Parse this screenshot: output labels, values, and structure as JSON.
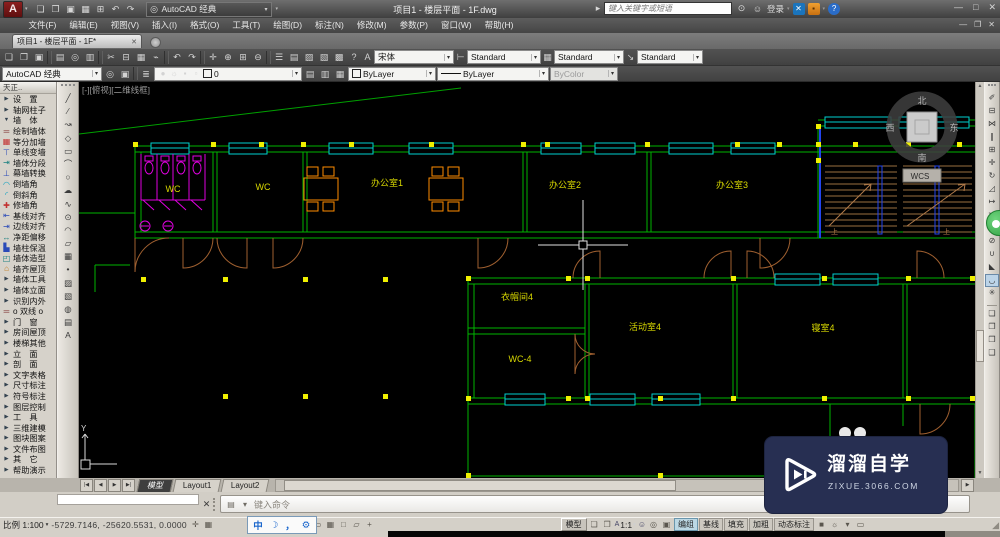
{
  "colors": {
    "canvas_bg": "#000000",
    "wall_green": "#00b400",
    "window_cyan": "#00d0d0",
    "grip_yellow": "#f0f000",
    "fixture_magenta": "#e000e0",
    "furniture_orange": "#ff8c00",
    "door_brown": "#a06030",
    "label_yellow": "#d8d800",
    "stair_rail_blue": "#2244ee",
    "watermark_bg": "#272f52",
    "badge_green": "#2fae3f"
  },
  "titlebar": {
    "logo": "A",
    "qat": [
      {
        "n": "new-button",
        "icn": "new-file",
        "i": "❏"
      },
      {
        "n": "open-button",
        "icn": "open-folder",
        "i": "❐"
      },
      {
        "n": "save-button",
        "icn": "save",
        "i": "▣"
      },
      {
        "n": "saveas-button",
        "icn": "save-as",
        "i": "▦"
      },
      {
        "n": "plot-button",
        "icn": "printer",
        "i": "⊞"
      },
      {
        "n": "undo-button",
        "icn": "undo-arrow",
        "i": "↶"
      },
      {
        "n": "redo-button",
        "icn": "redo-arrow",
        "i": "↷"
      }
    ],
    "workspace": "AutoCAD 经典",
    "title": "项目1 - 楼层平面 - 1F.dwg",
    "search_placeholder": "键入关键字或短语",
    "search_arrow": "▸",
    "binocular": "⊙",
    "person": "☺",
    "signin": "登录",
    "exchange_x": "✕",
    "win": {
      "min": "—",
      "max": "□",
      "close": "✕"
    },
    "help_q": "?"
  },
  "menubar": {
    "items": [
      {
        "label": "文件(F)",
        "n": "menu-file"
      },
      {
        "label": "编辑(E)",
        "n": "menu-edit"
      },
      {
        "label": "视图(V)",
        "n": "menu-view"
      },
      {
        "label": "插入(I)",
        "n": "menu-insert"
      },
      {
        "label": "格式(O)",
        "n": "menu-format"
      },
      {
        "label": "工具(T)",
        "n": "menu-tools"
      },
      {
        "label": "绘图(D)",
        "n": "menu-draw"
      },
      {
        "label": "标注(N)",
        "n": "menu-dimension"
      },
      {
        "label": "修改(M)",
        "n": "menu-modify"
      },
      {
        "label": "参数(P)",
        "n": "menu-parametric"
      },
      {
        "label": "窗口(W)",
        "n": "menu-window"
      },
      {
        "label": "帮助(H)",
        "n": "menu-help"
      }
    ],
    "win": {
      "min": "—",
      "restore": "❐",
      "close": "✕"
    }
  },
  "tabbar": {
    "tab": "项目1 - 楼层平面 - 1F*",
    "close": "✕"
  },
  "toolbar1": {
    "icons": [
      {
        "n": "new-button",
        "icn": "new-file",
        "i": "❏"
      },
      {
        "n": "open-button",
        "icn": "open-folder",
        "i": "❐"
      },
      {
        "n": "save-button",
        "icn": "save",
        "i": "▣"
      },
      {
        "sep": true
      },
      {
        "n": "plot-button",
        "icn": "printer",
        "i": "▤"
      },
      {
        "n": "preview-button",
        "icn": "print-preview",
        "i": "◎"
      },
      {
        "n": "publish-button",
        "icn": "publish",
        "i": "▥"
      },
      {
        "sep": true
      },
      {
        "n": "cut-button",
        "icn": "scissors",
        "i": "✂"
      },
      {
        "n": "copy-button",
        "icn": "copy",
        "i": "⊟"
      },
      {
        "n": "paste-button",
        "icn": "clipboard",
        "i": "▦"
      },
      {
        "n": "match-properties-button",
        "icn": "paintbrush",
        "i": "⌁"
      },
      {
        "sep": true
      },
      {
        "n": "undo-button",
        "icn": "undo-arrow",
        "i": "↶"
      },
      {
        "n": "redo-button",
        "icn": "redo-arrow",
        "i": "↷"
      },
      {
        "sep": true
      },
      {
        "n": "pan-button",
        "icn": "pan-hand",
        "i": "✛"
      },
      {
        "n": "zoom-realtime-button",
        "icn": "zoom-plus",
        "i": "⊕"
      },
      {
        "n": "zoom-window-button",
        "icn": "zoom-window",
        "i": "⊞"
      },
      {
        "n": "zoom-previous-button",
        "icn": "zoom-minus",
        "i": "⊖"
      },
      {
        "sep": true
      },
      {
        "n": "properties-button",
        "icn": "properties",
        "i": "☰"
      },
      {
        "n": "design-center-button",
        "icn": "design-center",
        "i": "▤"
      },
      {
        "n": "tool-palettes-button",
        "icn": "tool-palettes",
        "i": "▨"
      },
      {
        "n": "sheet-set-button",
        "icn": "sheet-set",
        "i": "▧"
      },
      {
        "n": "markup-button",
        "icn": "markup",
        "i": "▩"
      },
      {
        "n": "help-button",
        "icn": "question-mark",
        "i": "?"
      }
    ],
    "style_icons": [
      {
        "i": "A"
      },
      {
        "i": "⊢"
      },
      {
        "i": "▦"
      },
      {
        "i": "↘"
      }
    ],
    "text_style": "宋体",
    "dim_style": "Standard",
    "table_style": "Standard",
    "mleader_style": "Standard"
  },
  "toolbar2": {
    "workspace": "AutoCAD 经典",
    "ws_icons": [
      {
        "n": "workspace-settings-button",
        "icn": "gear",
        "i": "◎"
      },
      {
        "n": "workspace-save-button",
        "icn": "save",
        "i": "▣"
      }
    ],
    "layer_props_icon": {
      "i": "≣"
    },
    "layer_icons": [
      {
        "n": "layer-on-toggle",
        "icn": "lightbulb",
        "i": "●",
        "c": "yel"
      },
      {
        "n": "layer-freeze-toggle",
        "icn": "sun",
        "i": "☼",
        "c": "org"
      },
      {
        "n": "layer-lock-toggle",
        "icn": "lock",
        "i": "▪",
        "c": "gry"
      },
      {
        "n": "layer-plot-toggle",
        "icn": "plot",
        "i": "▫",
        "c": "gry"
      }
    ],
    "layer": "0",
    "layer_btns": [
      {
        "n": "layer-states-button",
        "icn": "layer-states",
        "i": "▤"
      },
      {
        "n": "layer-previous-button",
        "icn": "layer-previous",
        "i": "▥"
      },
      {
        "n": "layer-isolate-button",
        "icn": "layer-isolate",
        "i": "▦"
      }
    ],
    "color": "ByLayer",
    "linetype": "ByLayer",
    "plot_style": "ByColor"
  },
  "palette": {
    "title": "天正..",
    "items": [
      {
        "i": "▶",
        "c": "arr",
        "label": "设　置",
        "n": "palette-settings"
      },
      {
        "i": "▶",
        "c": "arr",
        "label": "轴网柱子",
        "n": "palette-axis-column"
      },
      {
        "i": "▼",
        "c": "arr",
        "label": "墙　体",
        "n": "palette-wall-group"
      },
      {
        "i": "═",
        "c": "mrn",
        "label": "绘制墙体",
        "n": "palette-draw-wall"
      },
      {
        "i": "▦",
        "c": "red",
        "label": "等分加墙",
        "n": "palette-divide-wall"
      },
      {
        "i": "⊤",
        "c": "blu",
        "label": "单线变墙",
        "n": "palette-line-to-wall"
      },
      {
        "i": "⇥",
        "c": "tea",
        "label": "墙体分段",
        "n": "palette-wall-segment"
      },
      {
        "i": "⊥",
        "c": "blu",
        "label": "幕墙转换",
        "n": "palette-curtain-wall"
      },
      {
        "i": "◠",
        "c": "cya",
        "label": "倒墙角",
        "n": "palette-wall-fillet"
      },
      {
        "i": "◜",
        "c": "cya",
        "label": "倒斜角",
        "n": "palette-wall-chamfer"
      },
      {
        "i": "✚",
        "c": "red",
        "label": "修墙角",
        "n": "palette-fix-wall-corner"
      },
      {
        "i": "⇤",
        "c": "blu",
        "label": "基线对齐",
        "n": "palette-baseline-align"
      },
      {
        "i": "⇥",
        "c": "blu",
        "label": "边线对齐",
        "n": "palette-edge-align"
      },
      {
        "i": "↔",
        "c": "tea",
        "label": "净距偏移",
        "n": "palette-clear-offset"
      },
      {
        "i": "▙",
        "c": "blu",
        "label": "墙柱保温",
        "n": "palette-wall-insulation"
      },
      {
        "i": "◰",
        "c": "tea",
        "label": "墙体造型",
        "n": "palette-wall-modeling"
      },
      {
        "i": "⌂",
        "c": "org",
        "label": "墙齐屋顶",
        "n": "palette-wall-to-roof"
      },
      {
        "i": "▶",
        "c": "arr",
        "label": "墙体工具",
        "n": "palette-wall-tools"
      },
      {
        "i": "▶",
        "c": "arr",
        "label": "墙体立面",
        "n": "palette-wall-elevation"
      },
      {
        "i": "▶",
        "c": "arr",
        "label": "识别内外",
        "n": "palette-recognize-inout"
      },
      {
        "i": "═",
        "c": "mrn",
        "label": "o 双线 o",
        "n": "palette-double-line-toggle"
      },
      {
        "i": "▶",
        "c": "arr",
        "label": "门　窗",
        "n": "palette-door-window"
      },
      {
        "i": "▶",
        "c": "arr",
        "label": "房间屋顶",
        "n": "palette-room-roof"
      },
      {
        "i": "▶",
        "c": "arr",
        "label": "楼梯其他",
        "n": "palette-stairs-other"
      },
      {
        "i": "▶",
        "c": "arr",
        "label": "立　面",
        "n": "palette-elevation"
      },
      {
        "i": "▶",
        "c": "arr",
        "label": "剖　面",
        "n": "palette-section"
      },
      {
        "i": "▶",
        "c": "arr",
        "label": "文字表格",
        "n": "palette-text-table"
      },
      {
        "i": "▶",
        "c": "arr",
        "label": "尺寸标注",
        "n": "palette-dimension"
      },
      {
        "i": "▶",
        "c": "arr",
        "label": "符号标注",
        "n": "palette-symbol-annotation"
      },
      {
        "i": "▶",
        "c": "arr",
        "label": "图层控制",
        "n": "palette-layer-control"
      },
      {
        "i": "▶",
        "c": "arr",
        "label": "工　具",
        "n": "palette-tools"
      },
      {
        "i": "▶",
        "c": "arr",
        "label": "三维建模",
        "n": "palette-3d-modeling"
      },
      {
        "i": "▶",
        "c": "arr",
        "label": "图块图案",
        "n": "palette-block-pattern"
      },
      {
        "i": "▶",
        "c": "arr",
        "label": "文件布图",
        "n": "palette-file-layout"
      },
      {
        "i": "▶",
        "c": "arr",
        "label": "其　它",
        "n": "palette-others"
      },
      {
        "i": "▶",
        "c": "arr",
        "label": "帮助演示",
        "n": "palette-help-demo"
      }
    ]
  },
  "draw_toolbar": {
    "icons": [
      {
        "n": "line-tool",
        "icn": "line",
        "i": "╱"
      },
      {
        "n": "xline-tool",
        "icn": "construction-line",
        "i": "∕"
      },
      {
        "n": "polyline-tool",
        "icn": "polyline",
        "i": "↝"
      },
      {
        "n": "polygon-tool",
        "icn": "polygon",
        "i": "◇"
      },
      {
        "n": "rectangle-tool",
        "icn": "rectangle",
        "i": "▭"
      },
      {
        "n": "arc-tool",
        "icn": "arc",
        "i": "⌒"
      },
      {
        "n": "circle-tool",
        "icn": "circle",
        "i": "○"
      },
      {
        "n": "revcloud-tool",
        "icn": "revision-cloud",
        "i": "☁"
      },
      {
        "n": "spline-tool",
        "icn": "spline",
        "i": "∿"
      },
      {
        "n": "ellipse-tool",
        "icn": "ellipse",
        "i": "⊙"
      },
      {
        "n": "ellipse-arc-tool",
        "icn": "ellipse-arc",
        "i": "◠"
      },
      {
        "n": "insert-block-tool",
        "icn": "insert-block",
        "i": "▱"
      },
      {
        "n": "make-block-tool",
        "icn": "make-block",
        "i": "▦"
      },
      {
        "n": "point-tool",
        "icn": "point",
        "i": "•"
      },
      {
        "n": "hatch-tool",
        "icn": "hatch",
        "i": "▨"
      },
      {
        "n": "gradient-tool",
        "icn": "gradient",
        "i": "▧"
      },
      {
        "n": "region-tool",
        "icn": "region",
        "i": "◍"
      },
      {
        "n": "table-tool",
        "icn": "table",
        "i": "▤"
      },
      {
        "n": "mtext-tool",
        "icn": "multiline-text",
        "i": "A"
      }
    ]
  },
  "modify_toolbar": {
    "icons": [
      {
        "n": "erase-tool",
        "icn": "eraser",
        "i": "✐"
      },
      {
        "n": "copy-tool",
        "icn": "copy",
        "i": "⊟"
      },
      {
        "n": "mirror-tool",
        "icn": "mirror",
        "i": "⋈"
      },
      {
        "n": "offset-tool",
        "icn": "offset",
        "i": "∥"
      },
      {
        "n": "array-tool",
        "icn": "array",
        "i": "⊞"
      },
      {
        "n": "move-tool",
        "icn": "move",
        "i": "✛"
      },
      {
        "n": "rotate-tool",
        "icn": "rotate",
        "i": "↻"
      },
      {
        "n": "scale-tool",
        "icn": "scale",
        "i": "◿"
      },
      {
        "n": "stretch-tool",
        "icn": "stretch",
        "i": "↦"
      },
      {
        "n": "trim-tool",
        "icn": "trim",
        "i": "✂"
      },
      {
        "n": "extend-tool",
        "icn": "extend",
        "i": "↠"
      },
      {
        "n": "break-tool",
        "icn": "break",
        "i": "⊘"
      },
      {
        "n": "join-tool",
        "icn": "join",
        "i": "∪"
      },
      {
        "n": "chamfer-tool",
        "icn": "chamfer",
        "i": "◣"
      },
      {
        "n": "fillet-tool",
        "icn": "fillet",
        "i": "◡",
        "cls": "pressed"
      },
      {
        "n": "explode-tool",
        "icn": "explode",
        "i": "✳"
      },
      {
        "sep": true
      },
      {
        "n": "bring-to-front-tool",
        "icn": "draw-order-front",
        "i": "❏"
      },
      {
        "n": "send-to-back-tool",
        "icn": "draw-order-back",
        "i": "❐"
      },
      {
        "n": "bring-above-tool",
        "icn": "draw-order-above",
        "i": "❒"
      },
      {
        "n": "send-under-tool",
        "icn": "draw-order-under",
        "i": "❑"
      }
    ]
  },
  "canvas": {
    "viewport_label": "[-][俯视][二维线框]",
    "rooms": [
      {
        "label": "WC"
      },
      {
        "label": "WC"
      },
      {
        "label": "办公室1"
      },
      {
        "label": "办公室2"
      },
      {
        "label": "办公室3"
      },
      {
        "label": "衣帽间4"
      },
      {
        "label": "WC-4"
      },
      {
        "label": "活动室4"
      },
      {
        "label": "寝室4"
      }
    ],
    "viewcube": {
      "north": "北",
      "south": "南",
      "west": "西",
      "east": "东",
      "wcs": "WCS"
    },
    "stair_up": "上",
    "ucs_y": "Y"
  },
  "layoutbar": {
    "nav": [
      {
        "i": "|◀",
        "n": "first-tab-button"
      },
      {
        "i": "◀",
        "n": "prev-tab-button"
      },
      {
        "i": "▶",
        "n": "next-tab-button"
      },
      {
        "i": "▶|",
        "n": "last-tab-button"
      }
    ],
    "tabs": [
      {
        "label": "模型",
        "n": "tab-model",
        "cls": "on"
      },
      {
        "label": "Layout1",
        "n": "tab-layout1"
      },
      {
        "label": "Layout2",
        "n": "tab-layout2"
      }
    ],
    "right_arrow": "▶"
  },
  "command": {
    "tools": [
      {
        "n": "customize-command-button",
        "icn": "keyboard",
        "i": "▤"
      },
      {
        "n": "recent-commands-button",
        "icn": "chevron-down",
        "i": "▾"
      }
    ],
    "prompt": "键入命令"
  },
  "statusbar": {
    "scale": "比例 1:100",
    "coords": "-5729.7146, -25620.5531, 0.0000",
    "pre_icons": [
      {
        "n": "infer-button",
        "icn": "infer",
        "i": "✛"
      },
      {
        "n": "snap-button",
        "icn": "snap-grid",
        "i": "▦"
      }
    ],
    "ime": [
      {
        "i": "中",
        "icn": "ime-language",
        "n": "ime-language-button"
      },
      {
        "i": "☽",
        "icn": "ime-halfwidth-moon",
        "n": "ime-shape-button"
      },
      {
        "i": "，",
        "icn": "ime-punctuation",
        "n": "ime-punct-button"
      },
      {
        "i": "⚙",
        "icn": "ime-settings-gear",
        "n": "ime-settings-button"
      }
    ],
    "mid_icons": [
      {
        "n": "ortho-button",
        "icn": "ortho",
        "i": "∟"
      },
      {
        "n": "polar-button",
        "icn": "polar-tracking",
        "i": "✛"
      },
      {
        "n": "osnap-button",
        "icn": "object-snap",
        "i": "▭"
      },
      {
        "n": "otrack-button",
        "icn": "object-track",
        "i": "▦"
      },
      {
        "n": "ducs-button",
        "icn": "dynamic-ucs",
        "i": "□"
      },
      {
        "n": "dyn-button",
        "icn": "dynamic-input",
        "i": "▱"
      },
      {
        "n": "lwt-button",
        "icn": "lineweight",
        "i": "+"
      }
    ],
    "model": "模型",
    "paper_icons": [
      {
        "n": "quick-view-layouts-button",
        "icn": "layout-sheet",
        "i": "❏"
      },
      {
        "n": "quick-view-drawings-button",
        "icn": "drawing-sheet",
        "i": "❐"
      }
    ],
    "annot_a": "A",
    "annot_scale": "1:1",
    "person_icon": "☺",
    "mini_icons": [
      {
        "n": "annotation-visibility-button",
        "icn": "annotation-visibility",
        "i": "◎"
      },
      {
        "n": "autoscale-button",
        "icn": "autoscale",
        "i": "▣"
      }
    ],
    "toggles": [
      {
        "label": "编组",
        "n": "toggle-group",
        "cls": "on"
      },
      {
        "label": "基线",
        "n": "toggle-baseline"
      },
      {
        "label": "填充",
        "n": "toggle-fill"
      },
      {
        "label": "加粗",
        "n": "toggle-bold"
      },
      {
        "label": "动态标注",
        "n": "toggle-dynamic-dim"
      }
    ],
    "end_icons": [
      {
        "n": "tz-status-button",
        "icn": "green-square",
        "i": "■",
        "c": "grn"
      },
      {
        "n": "bulb-button",
        "icn": "lightbulb",
        "i": "☼",
        "c": "yel"
      },
      {
        "n": "status-menu-button",
        "icn": "chevron-down",
        "i": "▾"
      },
      {
        "n": "clean-screen-button",
        "icn": "clean-screen",
        "i": "▭"
      }
    ],
    "grip": "◢"
  },
  "watermark": {
    "line1": "溜溜自学",
    "line2": "ZIXUE.3066.COM"
  }
}
